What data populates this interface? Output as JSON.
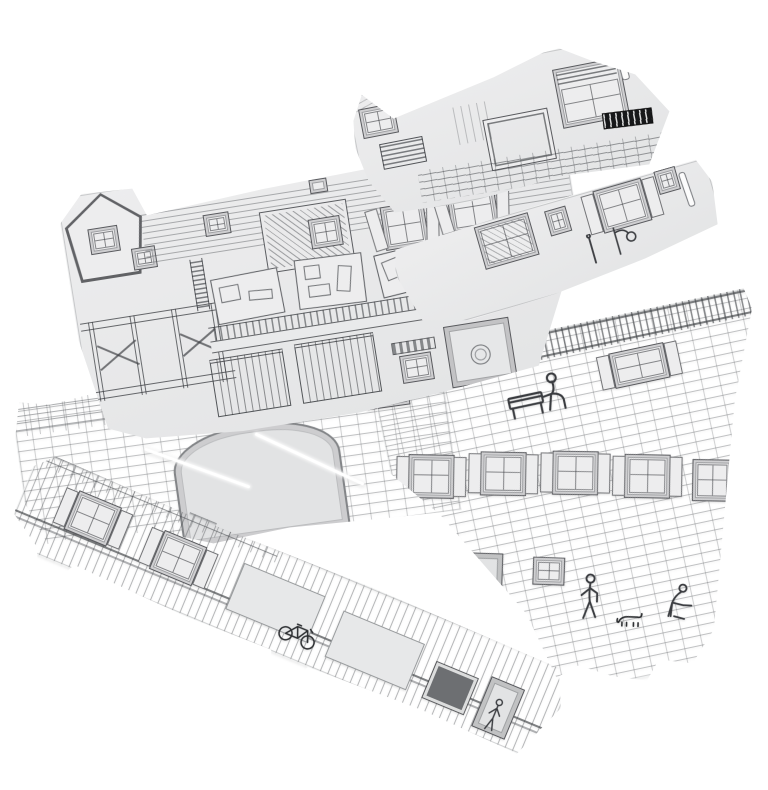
{
  "scene": {
    "description": "Product photograph of six flat die-cut papercraft model sheets fanned out on a white background. Each light-grey cardboard sheet is printed with black line art of old town house facades: gables, shingled roofs, dormers, shuttered windows, shopfronts, timber framing, stone-block walls with an arched gateway, doors, a park bench, street lamp, clock, bicycle and small human figures. Slots, notches and glue tabs are cut into the sheet edges.",
    "background_color": "#ffffff",
    "object_count": 6
  },
  "colors": {
    "bg": "#ffffff",
    "paper": "#ededee",
    "paper2": "#e3e4e5",
    "panel": "#e2e3e4",
    "ink": "#3e4043",
    "dark": "#6d6f72",
    "black": "#17181a",
    "slot": "#fcfcfc",
    "fold": "#ffffff"
  },
  "sheets": [
    {
      "id": "sheet-top-facade",
      "description": "Top sheet: house facade strip with left roof gable and attic window, louvered vent, large open casement outline, tall window with louvered transom, diagonal brick course band, black printed label patch and a cut slot near the right edge."
    },
    {
      "id": "sheet-roof-house",
      "description": "Large second sheet: pentagon dormer gable, long shingled roof with dormer windows and chimney, cut-away interior rooms with furniture doodles, balcony railing, timber-frame wall with cross braces and ladder, shopfront windows, striped awning window and a wide doorway with a round emblem."
    },
    {
      "id": "sheet-window-strip",
      "description": "Right upper strip: row of windows with curtains and louvered shutters, two small windows, a wall-mounted street lamp drawing and a cut slot near the right end."
    },
    {
      "id": "sheet-stone-left",
      "description": "Left part of the wide stone sheet: squared stone-block wall with arched gateway, white fold creases radiating from the arch and a wall clock."
    },
    {
      "id": "sheet-stone-right",
      "description": "Right part of the wide stone sheet: fence railing band, shuttered windows, a figure seated on a bench, a row of five shuttered windows, a door with standing figure, a figure pushing a cart and a small dog on stone blockwork."
    },
    {
      "id": "sheet-plank-strip",
      "description": "Long bottom strip rotated diagonally: vertical plank siding with brick top course, two shuttered windows, rail lines, two blank light panels, a dark window opening, a door and a bicycle doodle; glue tabs protrude from the edges."
    }
  ]
}
